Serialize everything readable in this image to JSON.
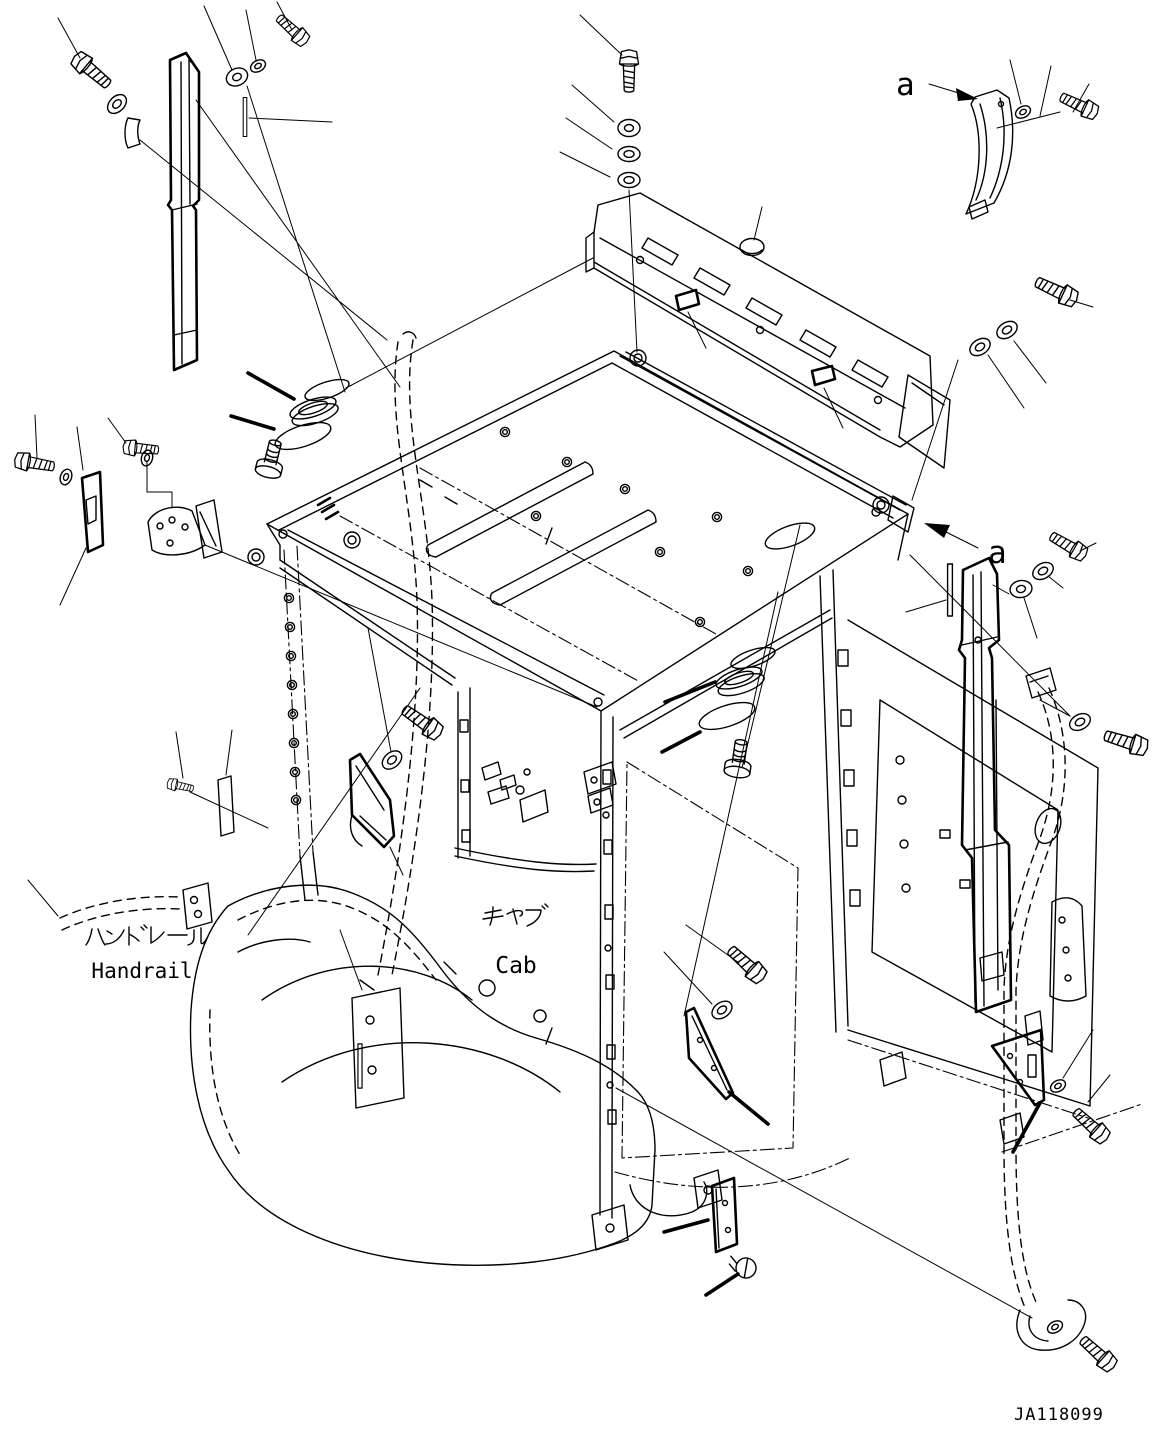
{
  "diagram": {
    "background": "#ffffff",
    "line_color": "#000000",
    "labels": {
      "handrail_jp": "ハンドレール",
      "handrail_en": "Handrail",
      "cab_jp": "キャブ",
      "cab_en": "Cab",
      "view_arrow_top": "a",
      "view_arrow_side": "a",
      "drawing_number": "JA118099"
    }
  }
}
